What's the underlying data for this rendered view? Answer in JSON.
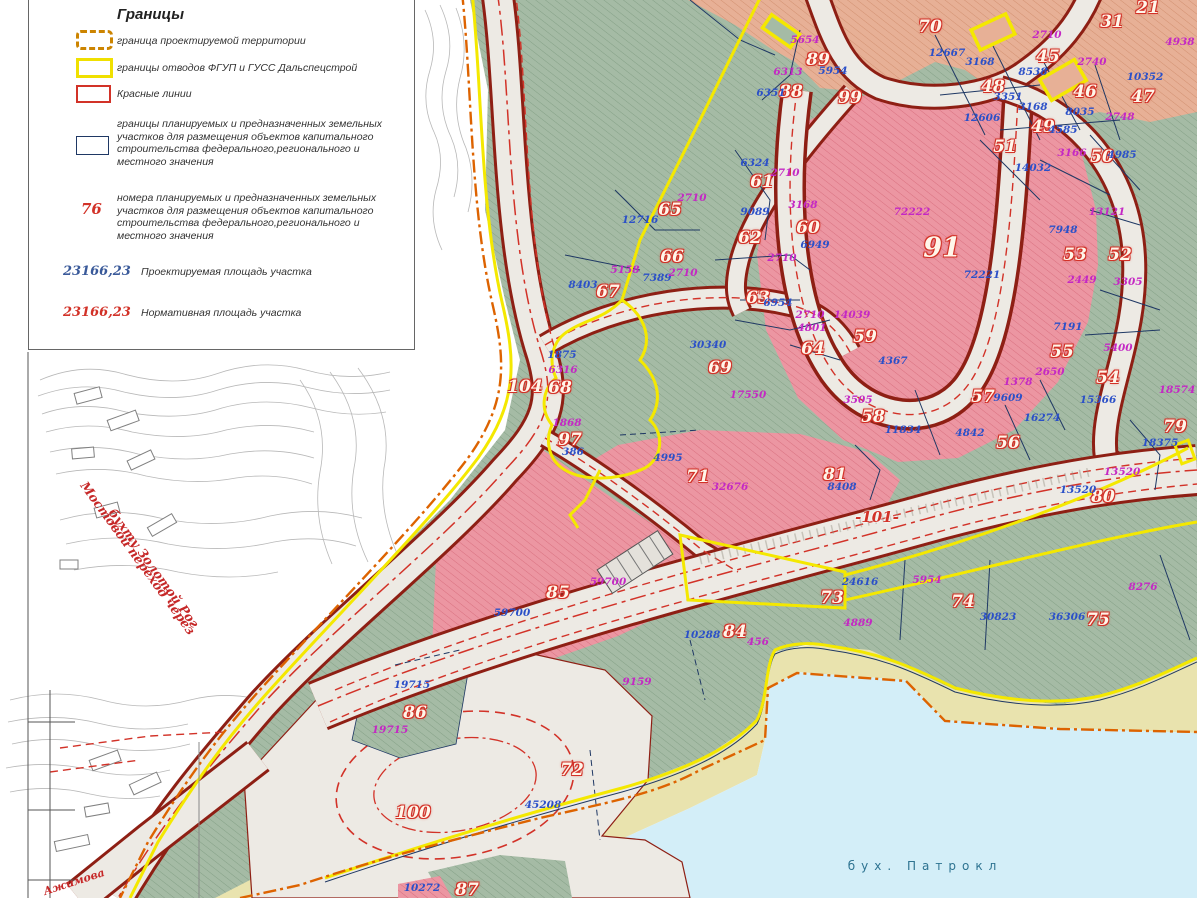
{
  "colors": {
    "green": "#a5bba5",
    "greenHatch": "#84a086",
    "pink": "#ec96a2",
    "pinkHatch": "#d9707f",
    "peach": "#e7b096",
    "peachHatch": "#d29070",
    "road": "#edeae4",
    "casing": "#8e1f14",
    "red": "#d23228",
    "yellow": "#f4e800",
    "orange": "#dd6300",
    "navy": "#1f3864",
    "blue": "#2b50c8",
    "magenta": "#c428c4",
    "sea": "#d3eef8",
    "beach": "#e9e3ae"
  },
  "legend": {
    "title": "Границы",
    "items": [
      {
        "label": "граница проектируемой территории"
      },
      {
        "label": "границы отводов ФГУП и ГУСС Дальспецстрой"
      },
      {
        "label": "Красные линии"
      },
      {
        "label": "границы  планируемых и предназначенных земельных участков для размещения объектов капитального строительства федерального,регионального и местного значения"
      },
      {
        "symbol": "76",
        "label": "номера планируемых и предназначенных земельных участков для размещения объектов капитального строительства федерального,регионального и местного значения"
      },
      {
        "symbol": "23166,23",
        "label": "Проектируемая площадь участка"
      },
      {
        "symbol": "23166,23",
        "label": "Нормативная площадь участка"
      }
    ]
  },
  "labels": [
    {
      "t": "21",
      "x": 1148,
      "y": 8,
      "c": "p"
    },
    {
      "t": "31",
      "x": 1112,
      "y": 22,
      "c": "p"
    },
    {
      "t": "45",
      "x": 1048,
      "y": 57,
      "c": "p"
    },
    {
      "t": "46",
      "x": 1085,
      "y": 92,
      "c": "p"
    },
    {
      "t": "47",
      "x": 1143,
      "y": 97,
      "c": "p"
    },
    {
      "t": "48",
      "x": 993,
      "y": 87,
      "c": "p"
    },
    {
      "t": "49",
      "x": 1043,
      "y": 127,
      "c": "p"
    },
    {
      "t": "50",
      "x": 1102,
      "y": 157,
      "c": "p"
    },
    {
      "t": "51",
      "x": 1005,
      "y": 147,
      "c": "p"
    },
    {
      "t": "52",
      "x": 1120,
      "y": 255,
      "c": "p"
    },
    {
      "t": "53",
      "x": 1075,
      "y": 255,
      "c": "p"
    },
    {
      "t": "54",
      "x": 1108,
      "y": 378,
      "c": "p"
    },
    {
      "t": "55",
      "x": 1062,
      "y": 352,
      "c": "p"
    },
    {
      "t": "56",
      "x": 1008,
      "y": 443,
      "c": "p"
    },
    {
      "t": "57",
      "x": 983,
      "y": 397,
      "c": "p"
    },
    {
      "t": "58",
      "x": 873,
      "y": 417,
      "c": "p"
    },
    {
      "t": "59",
      "x": 865,
      "y": 337,
      "c": "p"
    },
    {
      "t": "60",
      "x": 808,
      "y": 228,
      "c": "p"
    },
    {
      "t": "61",
      "x": 762,
      "y": 182,
      "c": "p"
    },
    {
      "t": "62",
      "x": 750,
      "y": 238,
      "c": "p"
    },
    {
      "t": "63",
      "x": 758,
      "y": 298,
      "c": "p"
    },
    {
      "t": "64",
      "x": 813,
      "y": 349,
      "c": "p"
    },
    {
      "t": "65",
      "x": 670,
      "y": 210,
      "c": "p"
    },
    {
      "t": "66",
      "x": 672,
      "y": 257,
      "c": "p"
    },
    {
      "t": "67",
      "x": 608,
      "y": 292,
      "c": "p"
    },
    {
      "t": "68",
      "x": 560,
      "y": 388,
      "c": "p"
    },
    {
      "t": "69",
      "x": 720,
      "y": 368,
      "c": "p"
    },
    {
      "t": "70",
      "x": 930,
      "y": 27,
      "c": "p"
    },
    {
      "t": "71",
      "x": 698,
      "y": 477,
      "c": "p"
    },
    {
      "t": "72",
      "x": 572,
      "y": 770,
      "c": "p"
    },
    {
      "t": "73",
      "x": 832,
      "y": 598,
      "c": "p"
    },
    {
      "t": "74",
      "x": 963,
      "y": 602,
      "c": "p"
    },
    {
      "t": "75",
      "x": 1098,
      "y": 620,
      "c": "p"
    },
    {
      "t": "79",
      "x": 1175,
      "y": 427,
      "c": "p"
    },
    {
      "t": "80",
      "x": 1103,
      "y": 497,
      "c": "p"
    },
    {
      "t": "81",
      "x": 835,
      "y": 475,
      "c": "p"
    },
    {
      "t": "84",
      "x": 735,
      "y": 632,
      "c": "p"
    },
    {
      "t": "85",
      "x": 558,
      "y": 593,
      "c": "p"
    },
    {
      "t": "86",
      "x": 415,
      "y": 713,
      "c": "p"
    },
    {
      "t": "87",
      "x": 467,
      "y": 890,
      "c": "p"
    },
    {
      "t": "88",
      "x": 791,
      "y": 92,
      "c": "p"
    },
    {
      "t": "89",
      "x": 818,
      "y": 60,
      "c": "p"
    },
    {
      "t": "91",
      "x": 942,
      "y": 248,
      "c": "big"
    },
    {
      "t": "97",
      "x": 570,
      "y": 440,
      "c": "p"
    },
    {
      "t": "99",
      "x": 850,
      "y": 98,
      "c": "p"
    },
    {
      "t": "100",
      "x": 413,
      "y": 813,
      "c": "p"
    },
    {
      "t": "104",
      "x": 525,
      "y": 387,
      "c": "p"
    },
    {
      "t": "-101-",
      "x": 877,
      "y": 517,
      "c": "r"
    },
    {
      "t": "5954",
      "x": 833,
      "y": 71,
      "c": "b"
    },
    {
      "t": "6351",
      "x": 771,
      "y": 93,
      "c": "b"
    },
    {
      "t": "12667",
      "x": 947,
      "y": 53,
      "c": "b"
    },
    {
      "t": "3168",
      "x": 980,
      "y": 62,
      "c": "b"
    },
    {
      "t": "8538",
      "x": 1033,
      "y": 72,
      "c": "b"
    },
    {
      "t": "10352",
      "x": 1145,
      "y": 77,
      "c": "b"
    },
    {
      "t": "8035",
      "x": 1080,
      "y": 112,
      "c": "b"
    },
    {
      "t": "3351",
      "x": 1008,
      "y": 97,
      "c": "b"
    },
    {
      "t": "3168",
      "x": 1033,
      "y": 107,
      "c": "b"
    },
    {
      "t": "12606",
      "x": 982,
      "y": 118,
      "c": "b"
    },
    {
      "t": "4585",
      "x": 1063,
      "y": 130,
      "c": "b"
    },
    {
      "t": "4985",
      "x": 1122,
      "y": 155,
      "c": "b"
    },
    {
      "t": "14032",
      "x": 1033,
      "y": 168,
      "c": "b"
    },
    {
      "t": "9089",
      "x": 755,
      "y": 212,
      "c": "b"
    },
    {
      "t": "6324",
      "x": 755,
      "y": 163,
      "c": "b"
    },
    {
      "t": "12716",
      "x": 640,
      "y": 220,
      "c": "b"
    },
    {
      "t": "7389",
      "x": 657,
      "y": 278,
      "c": "b"
    },
    {
      "t": "8403",
      "x": 583,
      "y": 285,
      "c": "b"
    },
    {
      "t": "6954",
      "x": 778,
      "y": 303,
      "c": "b"
    },
    {
      "t": "30340",
      "x": 708,
      "y": 345,
      "c": "b"
    },
    {
      "t": "1875",
      "x": 562,
      "y": 355,
      "c": "b"
    },
    {
      "t": "6949",
      "x": 815,
      "y": 245,
      "c": "b"
    },
    {
      "t": "72221",
      "x": 982,
      "y": 275,
      "c": "b"
    },
    {
      "t": "7948",
      "x": 1063,
      "y": 230,
      "c": "b"
    },
    {
      "t": "4367",
      "x": 893,
      "y": 361,
      "c": "b"
    },
    {
      "t": "9609",
      "x": 1008,
      "y": 398,
      "c": "b"
    },
    {
      "t": "11834",
      "x": 903,
      "y": 430,
      "c": "b"
    },
    {
      "t": "4842",
      "x": 970,
      "y": 433,
      "c": "b"
    },
    {
      "t": "16274",
      "x": 1042,
      "y": 418,
      "c": "b"
    },
    {
      "t": "15366",
      "x": 1098,
      "y": 400,
      "c": "b"
    },
    {
      "t": "18375",
      "x": 1160,
      "y": 443,
      "c": "b"
    },
    {
      "t": "13520",
      "x": 1078,
      "y": 490,
      "c": "b"
    },
    {
      "t": "8408",
      "x": 842,
      "y": 487,
      "c": "b"
    },
    {
      "t": "7191",
      "x": 1068,
      "y": 327,
      "c": "b"
    },
    {
      "t": "4995",
      "x": 668,
      "y": 458,
      "c": "b"
    },
    {
      "t": "59700",
      "x": 512,
      "y": 613,
      "c": "b"
    },
    {
      "t": "10288",
      "x": 702,
      "y": 635,
      "c": "b"
    },
    {
      "t": "24616",
      "x": 860,
      "y": 582,
      "c": "b"
    },
    {
      "t": "30823",
      "x": 998,
      "y": 617,
      "c": "b"
    },
    {
      "t": "36306",
      "x": 1067,
      "y": 617,
      "c": "b"
    },
    {
      "t": "45208",
      "x": 543,
      "y": 805,
      "c": "b"
    },
    {
      "t": "19715",
      "x": 412,
      "y": 685,
      "c": "b"
    },
    {
      "t": "10272",
      "x": 422,
      "y": 888,
      "c": "b"
    },
    {
      "t": "386",
      "x": 573,
      "y": 452,
      "c": "b"
    },
    {
      "t": "5654",
      "x": 805,
      "y": 40,
      "c": "m"
    },
    {
      "t": "6313",
      "x": 788,
      "y": 72,
      "c": "m"
    },
    {
      "t": "2710",
      "x": 1047,
      "y": 35,
      "c": "m"
    },
    {
      "t": "2740",
      "x": 1092,
      "y": 62,
      "c": "m"
    },
    {
      "t": "2748",
      "x": 1120,
      "y": 117,
      "c": "m"
    },
    {
      "t": "3166",
      "x": 1072,
      "y": 153,
      "c": "m"
    },
    {
      "t": "4938",
      "x": 1180,
      "y": 42,
      "c": "m"
    },
    {
      "t": "2710",
      "x": 692,
      "y": 198,
      "c": "m"
    },
    {
      "t": "2710",
      "x": 683,
      "y": 273,
      "c": "m"
    },
    {
      "t": "5158",
      "x": 625,
      "y": 270,
      "c": "m"
    },
    {
      "t": "2710",
      "x": 782,
      "y": 258,
      "c": "m"
    },
    {
      "t": "2710",
      "x": 810,
      "y": 315,
      "c": "m"
    },
    {
      "t": "4801",
      "x": 812,
      "y": 328,
      "c": "m"
    },
    {
      "t": "3168",
      "x": 803,
      "y": 205,
      "c": "m"
    },
    {
      "t": "2710",
      "x": 785,
      "y": 173,
      "c": "m"
    },
    {
      "t": "72222",
      "x": 912,
      "y": 212,
      "c": "m"
    },
    {
      "t": "14039",
      "x": 852,
      "y": 315,
      "c": "m"
    },
    {
      "t": "2449",
      "x": 1082,
      "y": 280,
      "c": "m"
    },
    {
      "t": "13121",
      "x": 1107,
      "y": 212,
      "c": "m"
    },
    {
      "t": "3305",
      "x": 1128,
      "y": 282,
      "c": "m"
    },
    {
      "t": "5400",
      "x": 1118,
      "y": 348,
      "c": "m"
    },
    {
      "t": "2650",
      "x": 1050,
      "y": 372,
      "c": "m"
    },
    {
      "t": "1378",
      "x": 1018,
      "y": 382,
      "c": "m"
    },
    {
      "t": "3505",
      "x": 858,
      "y": 400,
      "c": "m"
    },
    {
      "t": "18574",
      "x": 1177,
      "y": 390,
      "c": "m"
    },
    {
      "t": "13520",
      "x": 1122,
      "y": 472,
      "c": "m"
    },
    {
      "t": "6316",
      "x": 563,
      "y": 370,
      "c": "m"
    },
    {
      "t": "1868",
      "x": 567,
      "y": 423,
      "c": "m"
    },
    {
      "t": "17550",
      "x": 748,
      "y": 395,
      "c": "m"
    },
    {
      "t": "32676",
      "x": 730,
      "y": 487,
      "c": "m"
    },
    {
      "t": "59700",
      "x": 608,
      "y": 582,
      "c": "m"
    },
    {
      "t": "456",
      "x": 758,
      "y": 642,
      "c": "m"
    },
    {
      "t": "4889",
      "x": 858,
      "y": 623,
      "c": "m"
    },
    {
      "t": "5954",
      "x": 927,
      "y": 580,
      "c": "m"
    },
    {
      "t": "8276",
      "x": 1143,
      "y": 587,
      "c": "m"
    },
    {
      "t": "9159",
      "x": 637,
      "y": 682,
      "c": "m"
    },
    {
      "t": "19715",
      "x": 390,
      "y": 730,
      "c": "m"
    },
    {
      "t": "бух.  Патрокл",
      "x": 925,
      "y": 866,
      "c": "bay"
    },
    {
      "t": "Мостовой переход через",
      "x": 138,
      "y": 558,
      "c": "br",
      "rot": 54
    },
    {
      "t": "бухту Золотой Рог",
      "x": 154,
      "y": 568,
      "c": "br",
      "rot": 54
    },
    {
      "t": "Ажимова",
      "x": 74,
      "y": 882,
      "c": "st",
      "rot": -18
    }
  ]
}
